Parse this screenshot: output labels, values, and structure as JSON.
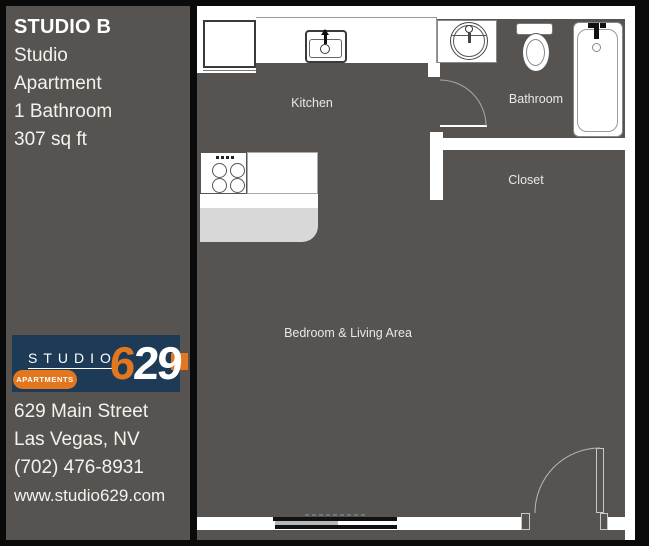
{
  "sidebar": {
    "title": "STUDIO B",
    "details": [
      "Studio",
      "Apartment",
      "1 Bathroom",
      "307 sq ft"
    ],
    "logo": {
      "studio": "STUDIO",
      "apartments": "APARTMENTS",
      "number_orange": "6",
      "number_white": "29"
    },
    "address": [
      "629 Main Street",
      "Las Vegas, NV",
      "(702) 476-8931",
      "www.studio629.com"
    ]
  },
  "floorplan": {
    "labels": {
      "kitchen": "Kitchen",
      "bathroom": "Bathroom",
      "closet": "Closet",
      "bedroom": "Bedroom & Living Area"
    },
    "fixtures": [
      "refrigerator",
      "kitchen-sink",
      "stove",
      "kitchen-island",
      "vanity-sink",
      "toilet",
      "bathtub",
      "sliding-window",
      "entry-door",
      "bathroom-door"
    ]
  },
  "colors": {
    "background_wall": "#0a0a0a",
    "sidebar_bg": "#575350",
    "floor": "#575350",
    "logo_navy": "#1d3a57",
    "accent_orange": "#e2771f",
    "island_gray": "#d8d8d8",
    "fixture_white": "#ffffff",
    "text": "#f4f2ee"
  }
}
